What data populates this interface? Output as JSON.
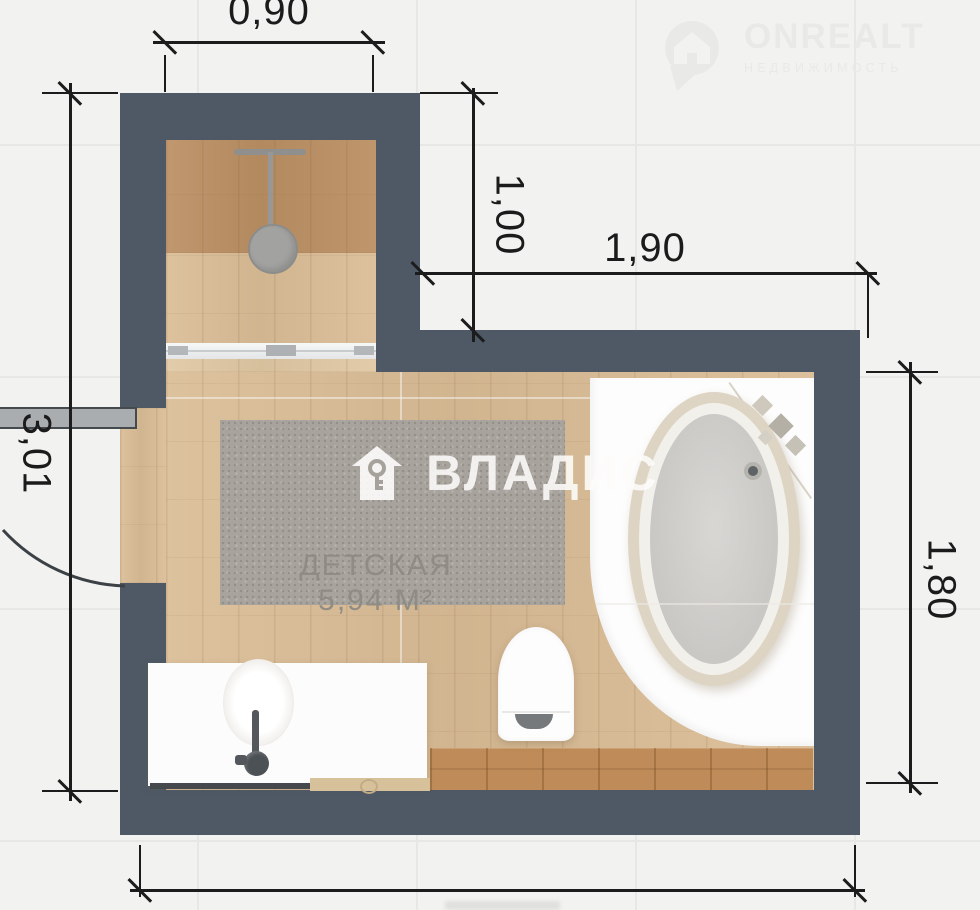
{
  "watermarks": {
    "onrealt": {
      "brand": "ONREALT",
      "tagline": "НЕДВИЖИМОСТЬ"
    },
    "vladis": {
      "brand": "ВЛАДИС"
    }
  },
  "room_label": {
    "name": "ДЕТСКАЯ",
    "area": "5,94 М²"
  },
  "dimensions": {
    "alcove_width": "0,90",
    "alcove_depth": "1,00",
    "main_width": "1,90",
    "left_height": "3,01",
    "right_height": "1,80"
  },
  "icons": {
    "onrealt_pin": "map-pin-house-icon",
    "vladis_logo": "house-key-icon",
    "shower": "shower-head-icon"
  },
  "colors": {
    "wall": "#4e5965",
    "floor_light": "#dabd96",
    "floor_dark": "#bb8f63",
    "shelf_wood": "#bf8b58",
    "rug": "#a8a49d",
    "fixture_white": "#fdfdfd",
    "dimension_line": "#1c1c1c",
    "tile_background": "#f2f2f1"
  }
}
